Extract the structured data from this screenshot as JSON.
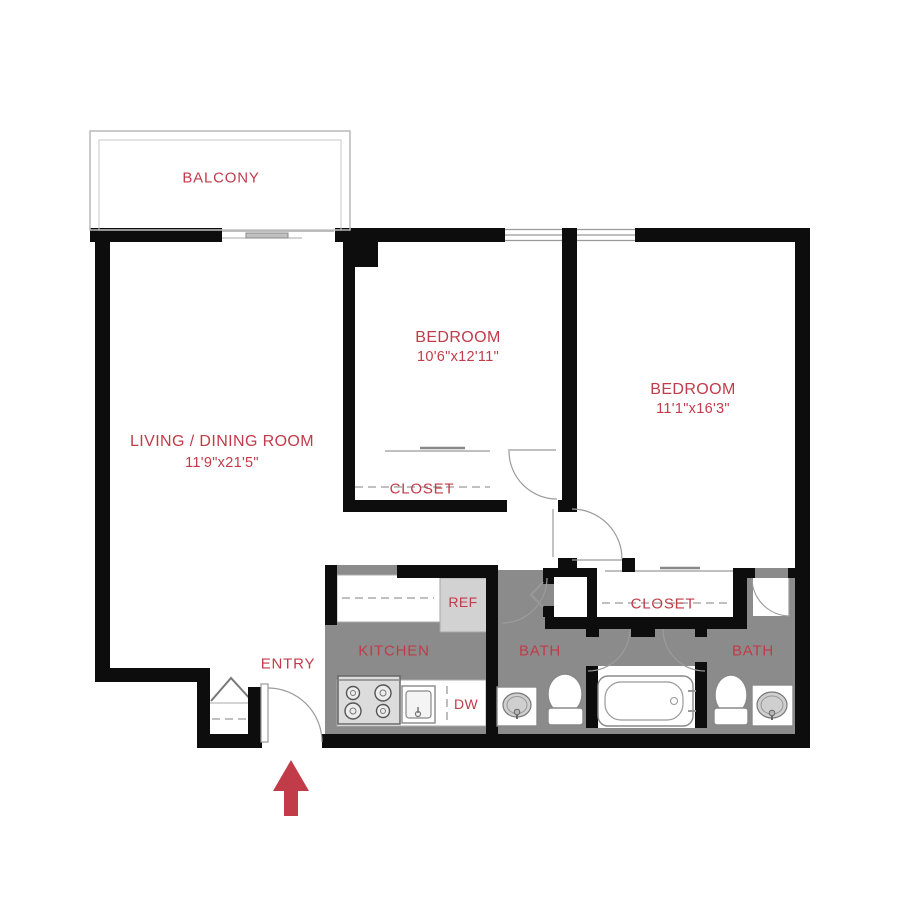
{
  "plan": {
    "balcony": {
      "label": "BALCONY"
    },
    "living_dining": {
      "label": "LIVING / DINING ROOM",
      "dimensions": "11'9\"x21'5\""
    },
    "bedroom_1": {
      "label": "BEDROOM",
      "dimensions": "10'6\"x12'11\""
    },
    "bedroom_2": {
      "label": "BEDROOM",
      "dimensions": "11'1\"x16'3\""
    },
    "closet_1": {
      "label": "CLOSET"
    },
    "closet_2": {
      "label": "CLOSET"
    },
    "kitchen": {
      "label": "KITCHEN",
      "refrigerator_label": "REF",
      "dishwasher_label": "DW"
    },
    "bath_1": {
      "label": "BATH"
    },
    "bath_2": {
      "label": "BATH"
    },
    "entry": {
      "label": "ENTRY"
    }
  },
  "colors": {
    "label_red": "#c13b49",
    "wall_black": "#0d0d0d",
    "floor_gray": "#8b8b8b",
    "appliance_gray": "#d2d2d2",
    "line_gray": "#999999",
    "background": "#ffffff"
  }
}
